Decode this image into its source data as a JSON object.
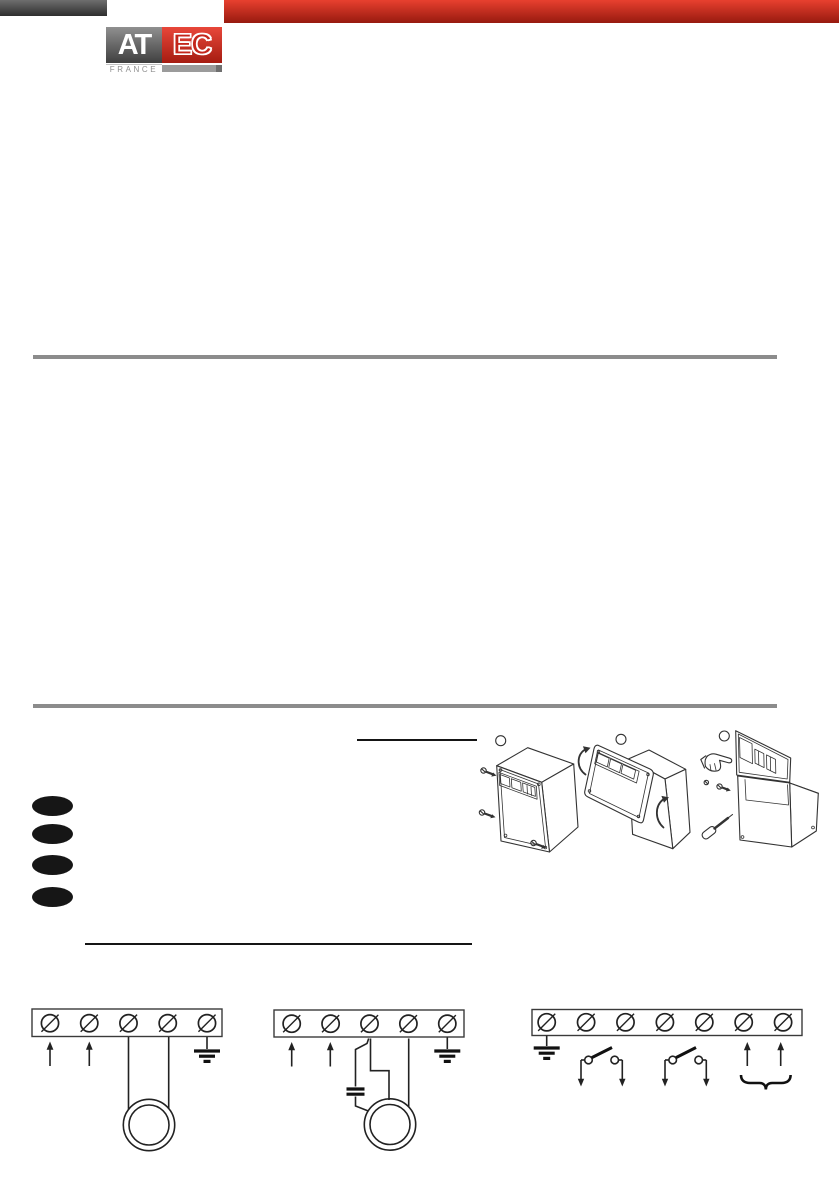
{
  "header": {
    "logo": {
      "at": "AT",
      "ec": "EC",
      "country": "FRANCE"
    }
  },
  "colors": {
    "top_bar_dark": "#4a4a4a",
    "top_bar_red": "#cf2b1f",
    "logo_gray_box": "#6b6b6b",
    "logo_red_box": "#c9251a",
    "logo_letters": "#ffffff",
    "france_text": "#8f8f8f",
    "divider_gray": "#8c8c8c",
    "line_art_ink": "#333333",
    "bullet_black": "#161616"
  },
  "figures": {
    "steps": [
      {
        "marker": "empty-circle",
        "icon": "closed-wall-box-with-mounting-screws"
      },
      {
        "marker": "empty-circle",
        "icon": "cover-swinging-open-with-curved-arrows"
      },
      {
        "marker": "empty-circle",
        "icon": "pointing-hand-screwdriver-open-base-box"
      }
    ]
  },
  "wiring": {
    "strips": [
      {
        "count": 5,
        "start_x": 50,
        "step_x": 39.25,
        "cy": 1023.2,
        "r": 8.6,
        "icons": [
          "up-arrow",
          "up-arrow",
          "motor-coil",
          "earth-ground"
        ]
      },
      {
        "count": 5,
        "start_x": 291.7,
        "step_x": 38.9,
        "cy": 1023.7,
        "r": 8.6,
        "icons": [
          "up-arrow",
          "up-arrow",
          "capacitor",
          "motor-coil",
          "earth-ground"
        ]
      },
      {
        "count": 7,
        "start_x": 546.7,
        "step_x": 39.4,
        "cy": 1022.3,
        "r": 8.6,
        "icons": [
          "earth-ground",
          "switch",
          "switch",
          "up-arrow",
          "up-arrow",
          "underbrace"
        ]
      }
    ]
  }
}
